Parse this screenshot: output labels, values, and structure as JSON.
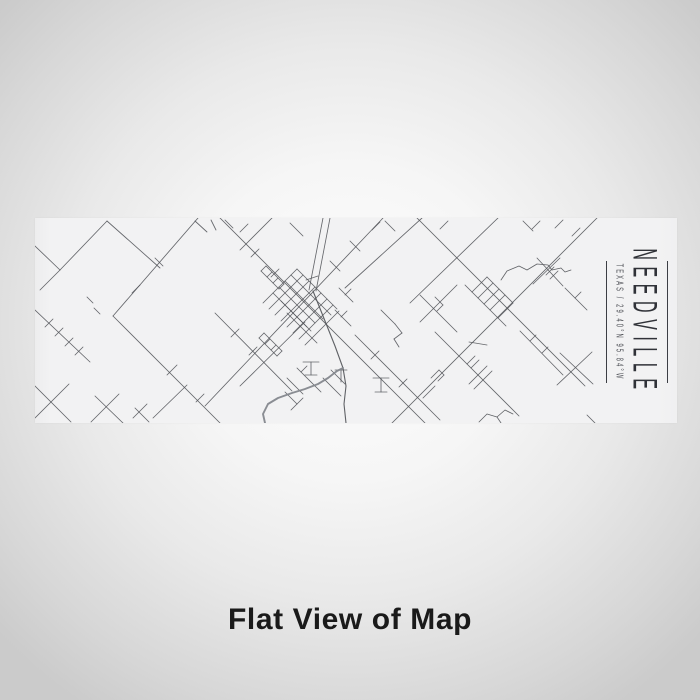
{
  "product_view": {
    "caption": "Flat View of Map",
    "map_label": {
      "title": "NEEDVILLE",
      "subtitle": "TEXAS / 29.40°N 95.84°W"
    },
    "colors": {
      "background_center": "#fdfdfd",
      "background_edge": "#cbcbcb",
      "strip_background": "#f2f2f3",
      "road": "#56585d",
      "river": "#84878d",
      "label_text": "#303238",
      "caption_text": "#1a1a1a"
    },
    "map": {
      "roads": [
        [
          0,
          28,
          25,
          52
        ],
        [
          25,
          52,
          72,
          3
        ],
        [
          25,
          52,
          5,
          72
        ],
        [
          72,
          3,
          125,
          50
        ],
        [
          163,
          0,
          78,
          98
        ],
        [
          78,
          98,
          185,
          205
        ],
        [
          0,
          92,
          55,
          144
        ],
        [
          10,
          109,
          18,
          101
        ],
        [
          20,
          118,
          28,
          110
        ],
        [
          30,
          128,
          38,
          120
        ],
        [
          40,
          137,
          48,
          129
        ],
        [
          52,
          79,
          58,
          85
        ],
        [
          59,
          90,
          65,
          96
        ],
        [
          120,
          40,
          128,
          48
        ],
        [
          97,
          75,
          105,
          67
        ],
        [
          132,
          157,
          142,
          147
        ],
        [
          152,
          167,
          118,
          200
        ],
        [
          161,
          184,
          169,
          176
        ],
        [
          160,
          3,
          172,
          14
        ],
        [
          176,
          2,
          181,
          12
        ],
        [
          190,
          2,
          198,
          10
        ],
        [
          205,
          14,
          213,
          6
        ],
        [
          180,
          95,
          257,
          173
        ],
        [
          196,
          119,
          204,
          111
        ],
        [
          214,
          137,
          222,
          129
        ],
        [
          0,
          168,
          36,
          204
        ],
        [
          34,
          166,
          0,
          200
        ],
        [
          60,
          178,
          88,
          205
        ],
        [
          84,
          176,
          56,
          204
        ],
        [
          100,
          190,
          114,
          204
        ],
        [
          112,
          186,
          98,
          200
        ],
        [
          237,
          0,
          205,
          32
        ],
        [
          255,
          5,
          268,
          18
        ],
        [
          185,
          0,
          390,
          205
        ],
        [
          348,
          0,
          170,
          188
        ],
        [
          288,
          0,
          274,
          72
        ],
        [
          295,
          0,
          281,
          73
        ],
        [
          271,
          62,
          283,
          58
        ],
        [
          315,
          23,
          325,
          33
        ],
        [
          295,
          43,
          305,
          53
        ],
        [
          224,
          31,
          216,
          39
        ],
        [
          244,
          51,
          236,
          59
        ],
        [
          238,
          75,
          272,
          109
        ],
        [
          244,
          69,
          280,
          105
        ],
        [
          250,
          63,
          288,
          101
        ],
        [
          256,
          57,
          296,
          97
        ],
        [
          262,
          51,
          302,
          91
        ],
        [
          246,
          83,
          276,
          113
        ],
        [
          252,
          95,
          282,
          125
        ],
        [
          262,
          51,
          228,
          85
        ],
        [
          268,
          57,
          234,
          91
        ],
        [
          274,
          63,
          240,
          97
        ],
        [
          280,
          69,
          246,
          103
        ],
        [
          286,
          75,
          252,
          109
        ],
        [
          292,
          81,
          258,
          115
        ],
        [
          298,
          87,
          264,
          121
        ],
        [
          304,
          93,
          270,
          127
        ],
        [
          226,
          53,
          244,
          71
        ],
        [
          231,
          48,
          249,
          66
        ],
        [
          226,
          53,
          231,
          48
        ],
        [
          232,
          59,
          237,
          54
        ],
        [
          238,
          65,
          243,
          60
        ],
        [
          244,
          71,
          249,
          66
        ],
        [
          224,
          120,
          242,
          138
        ],
        [
          229,
          115,
          247,
          133
        ],
        [
          224,
          120,
          229,
          115
        ],
        [
          230,
          126,
          235,
          121
        ],
        [
          236,
          132,
          241,
          127
        ],
        [
          242,
          138,
          247,
          133
        ],
        [
          304,
          70,
          318,
          84
        ],
        [
          310,
          77,
          316,
          71
        ],
        [
          300,
          92,
          316,
          108
        ],
        [
          306,
          99,
          312,
          93
        ],
        [
          262,
          150,
          286,
          174
        ],
        [
          266,
          154,
          272,
          148
        ],
        [
          252,
          160,
          268,
          176
        ],
        [
          250,
          174,
          262,
          186
        ],
        [
          262,
          186,
          256,
          192
        ],
        [
          268,
          180,
          262,
          186
        ],
        [
          288,
          160,
          306,
          178
        ],
        [
          296,
          152,
          310,
          166
        ],
        [
          268,
          144,
          284,
          144
        ],
        [
          276,
          144,
          276,
          157
        ],
        [
          270,
          157,
          282,
          157
        ],
        [
          300,
          152,
          312,
          152
        ],
        [
          306,
          152,
          306,
          164
        ],
        [
          338,
          160,
          354,
          160
        ],
        [
          346,
          160,
          346,
          174
        ],
        [
          340,
          174,
          352,
          174
        ],
        [
          270,
          104,
          205,
          168
        ],
        [
          320,
          117,
          405,
          202
        ],
        [
          336,
          141,
          344,
          133
        ],
        [
          364,
          169,
          372,
          161
        ],
        [
          346,
          92,
          360,
          106
        ],
        [
          360,
          106,
          367,
          115
        ],
        [
          367,
          115,
          359,
          121
        ],
        [
          359,
          121,
          364,
          129
        ],
        [
          387,
          0,
          310,
          70
        ],
        [
          382,
          0,
          550,
          168
        ],
        [
          463,
          0,
          375,
          85
        ],
        [
          350,
          3,
          360,
          13
        ],
        [
          337,
          12,
          345,
          4
        ],
        [
          413,
          3,
          405,
          11
        ],
        [
          528,
          2,
          520,
          10
        ],
        [
          545,
          10,
          537,
          18
        ],
        [
          488,
          3,
          498,
          13
        ],
        [
          505,
          3,
          497,
          11
        ],
        [
          511,
          57,
          519,
          49
        ],
        [
          515,
          61,
          523,
          53
        ],
        [
          525,
          40,
          498,
          66
        ],
        [
          502,
          40,
          528,
          68
        ],
        [
          562,
          0,
          357,
          205
        ],
        [
          437,
          74,
          463,
          100
        ],
        [
          452,
          59,
          478,
          85
        ],
        [
          437,
          74,
          452,
          59
        ],
        [
          443,
          80,
          458,
          65
        ],
        [
          449,
          86,
          464,
          71
        ],
        [
          455,
          92,
          470,
          77
        ],
        [
          463,
          100,
          478,
          85
        ],
        [
          430,
          67,
          437,
          74
        ],
        [
          463,
          100,
          471,
          108
        ],
        [
          422,
          67,
          385,
          104
        ],
        [
          385,
          77,
          422,
          114
        ],
        [
          400,
          79,
          408,
          87
        ],
        [
          408,
          87,
          402,
          93
        ],
        [
          400,
          114,
          484,
          198
        ],
        [
          432,
          146,
          440,
          138
        ],
        [
          436,
          150,
          444,
          142
        ],
        [
          452,
          148,
          434,
          166
        ],
        [
          457,
          153,
          439,
          171
        ],
        [
          485,
          113,
          528,
          157
        ],
        [
          495,
          123,
          501,
          117
        ],
        [
          507,
          135,
          513,
          129
        ],
        [
          434,
          124,
          452,
          127
        ],
        [
          522,
          167,
          557,
          134
        ],
        [
          525,
          135,
          558,
          166
        ],
        [
          396,
          160,
          404,
          152
        ],
        [
          404,
          152,
          409,
          157
        ],
        [
          409,
          157,
          403,
          163
        ],
        [
          388,
          180,
          400,
          168
        ],
        [
          552,
          197,
          560,
          205
        ],
        [
          530,
          70,
          552,
          92
        ],
        [
          540,
          80,
          546,
          74
        ],
        [
          462,
          199,
          466,
          205
        ]
      ],
      "polylines": [
        {
          "role": "road",
          "width": 1.1,
          "points": [
            [
              278,
              73
            ],
            [
              288,
              98
            ],
            [
              300,
              128
            ],
            [
              308,
              150
            ],
            [
              311,
              168
            ],
            [
              309,
              186
            ],
            [
              311,
              205
            ]
          ]
        },
        {
          "role": "river",
          "width": 1.9,
          "points": [
            [
              230,
              205
            ],
            [
              228,
              196
            ],
            [
              233,
              186
            ],
            [
              243,
              180
            ],
            [
              257,
              175
            ],
            [
              270,
              171
            ],
            [
              283,
              166
            ],
            [
              293,
              160
            ],
            [
              302,
              153
            ],
            [
              308,
              150
            ]
          ]
        },
        {
          "role": "road",
          "width": 0.8,
          "points": [
            [
              466,
              62
            ],
            [
              472,
              53
            ],
            [
              484,
              48
            ],
            [
              492,
              52
            ],
            [
              502,
              46
            ],
            [
              513,
              47
            ],
            [
              517,
              52
            ],
            [
              526,
              50
            ],
            [
              530,
              54
            ],
            [
              536,
              52
            ]
          ]
        },
        {
          "role": "road",
          "width": 0.8,
          "points": [
            [
              444,
              204
            ],
            [
              452,
              196
            ],
            [
              462,
              199
            ],
            [
              470,
              192
            ],
            [
              478,
              196
            ]
          ]
        }
      ]
    }
  }
}
